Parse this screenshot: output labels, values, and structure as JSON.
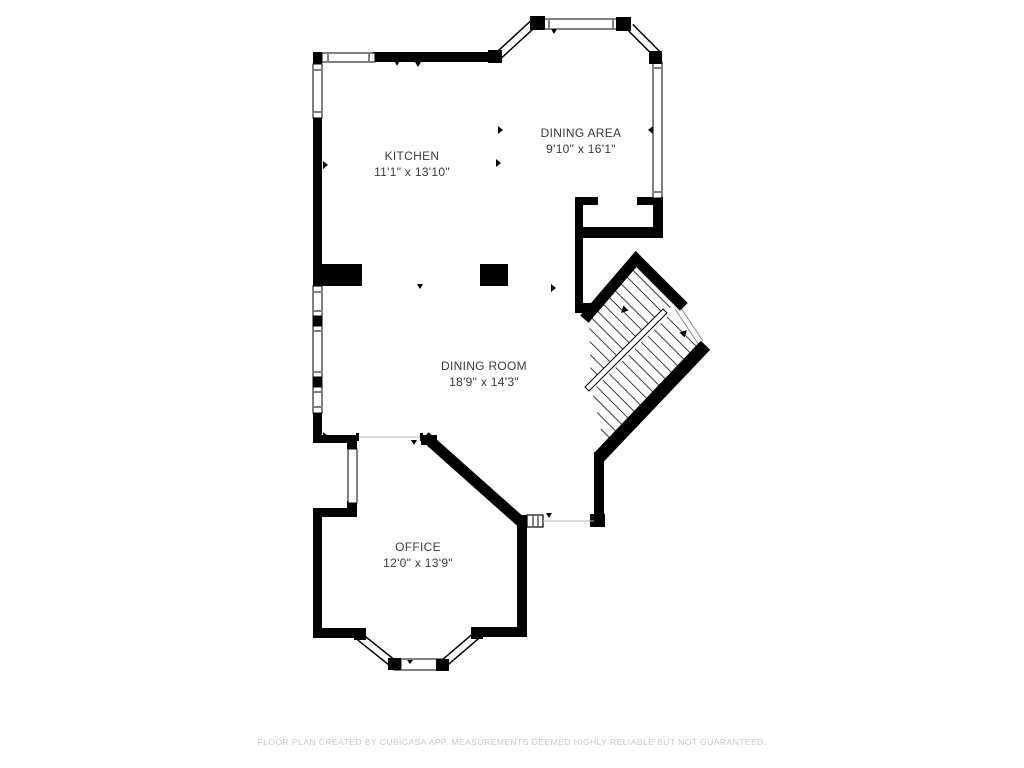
{
  "plan": {
    "rooms": [
      {
        "name": "KITCHEN",
        "dimensions": "11'1\" x 13'10\""
      },
      {
        "name": "DINING AREA",
        "dimensions": "9'10\" x 16'1\""
      },
      {
        "name": "DINING ROOM",
        "dimensions": "18'9\" x 14'3\""
      },
      {
        "name": "OFFICE",
        "dimensions": "12'0\" x 13'9\""
      }
    ],
    "footer": "FLOOR PLAN CREATED BY CUBICASA APP. MEASUREMENTS DEEMED HIGHLY RELIABLE BUT NOT GUARANTEED.",
    "colors": {
      "walls": "#000000",
      "background": "#ffffff",
      "room_text": "#3b3b3b",
      "footer_text": "#c8c8c8"
    }
  }
}
